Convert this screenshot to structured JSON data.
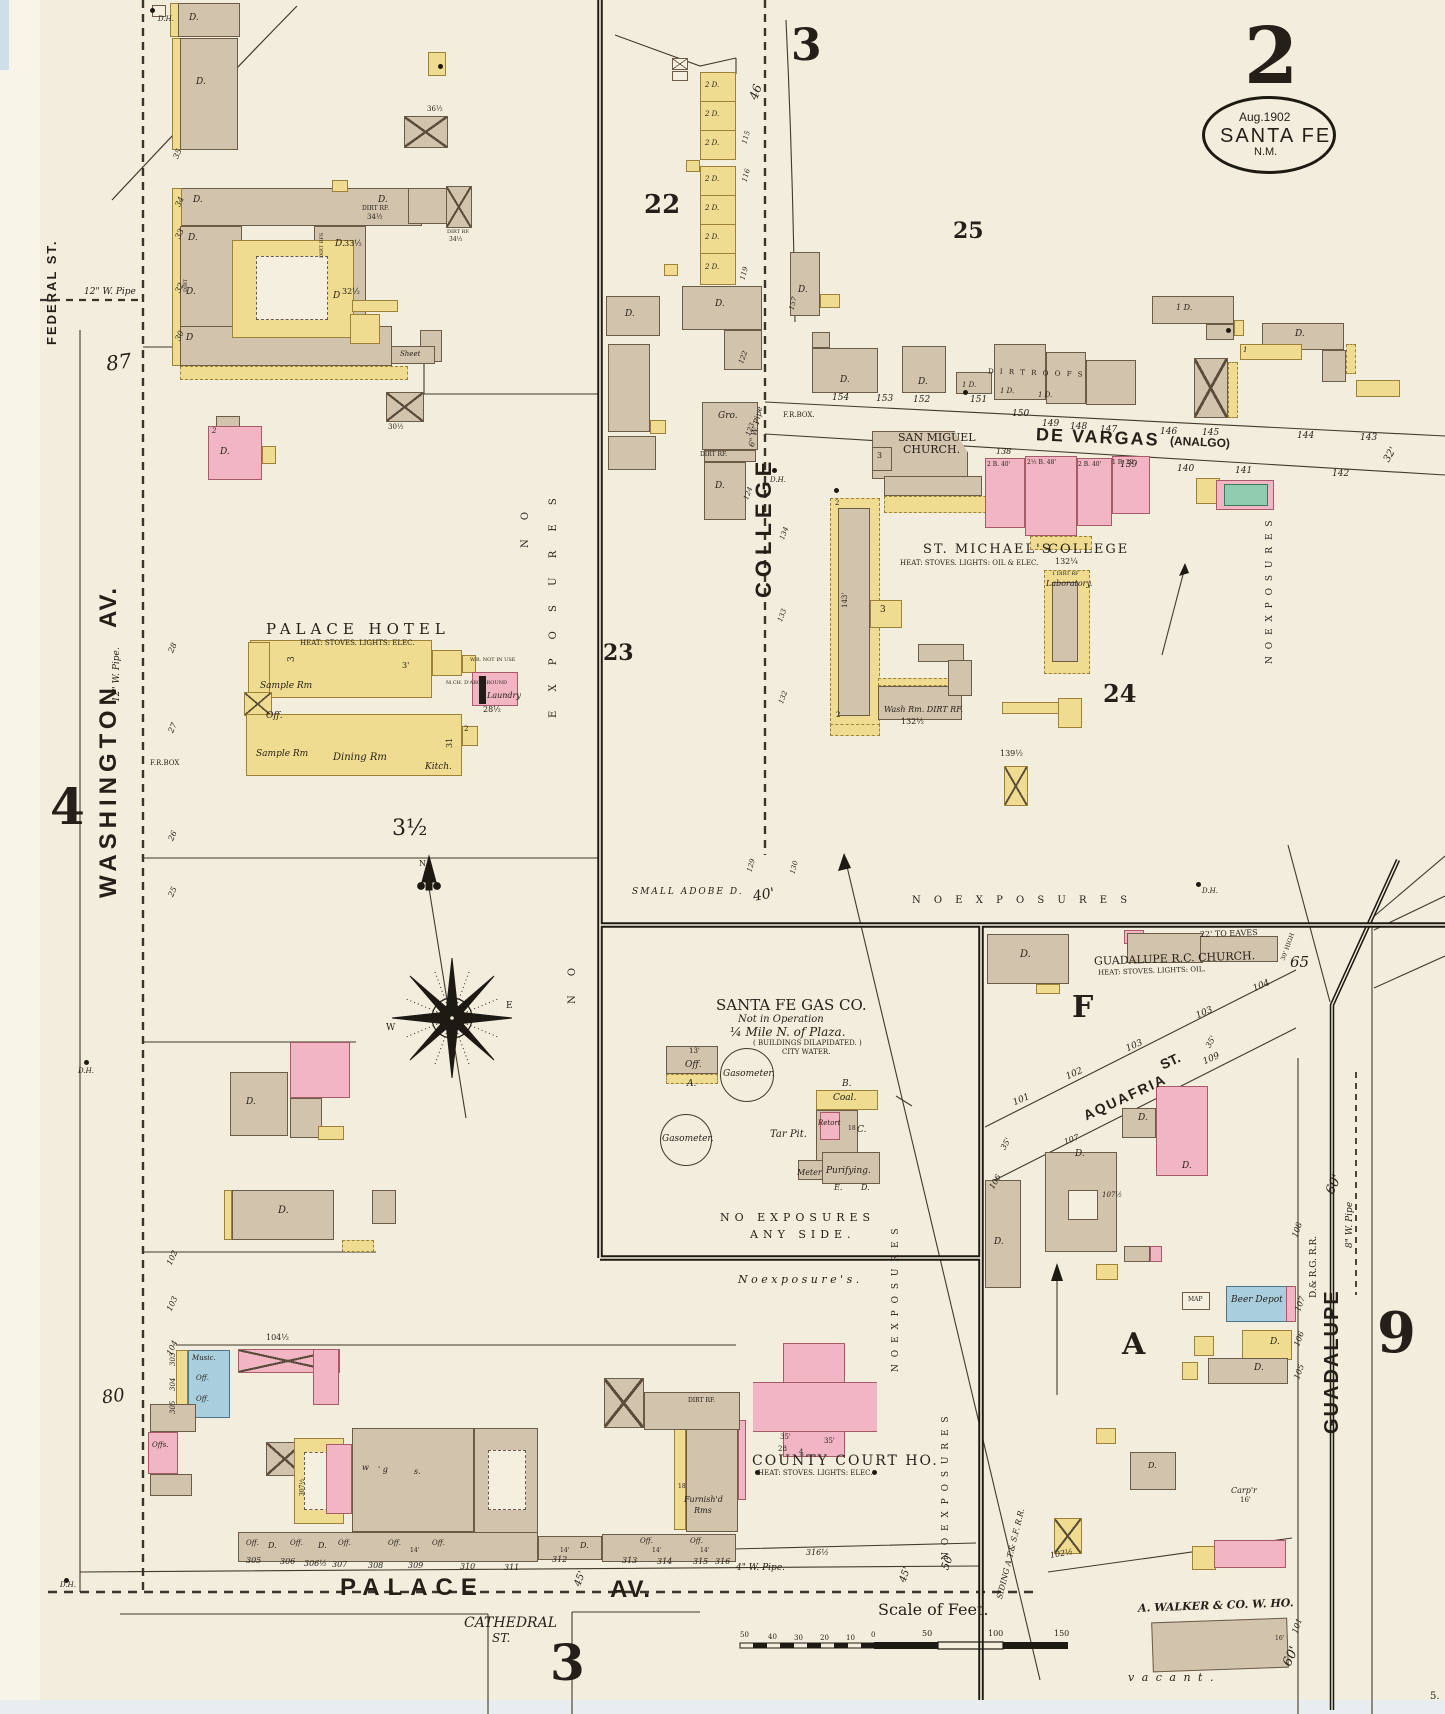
{
  "stamp": {
    "date": "Aug.1902",
    "city": "SANTA FE",
    "state": "N.M."
  },
  "sheet": {
    "number": "2",
    "corner3": "3",
    "corner4": "4",
    "corner9": "9",
    "corner3b": "3",
    "tiny5": "5."
  },
  "streets": {
    "federal": "FEDERAL ST.",
    "washington": "WASHINGTON",
    "washington_av": "AV.",
    "college": "COLLEGE",
    "de_vargas": "DE VARGAS",
    "analgo": "(ANALGO)",
    "palace": "PALACE",
    "palace_av": "AV.",
    "cathedral": "CATHEDRAL",
    "cathedral_st": "ST.",
    "aquafria": "AQUAFRIA",
    "aquafria_st": "ST.",
    "guadalupe": "GUADALUPE",
    "railroad": "D.& R.G. R.R.",
    "siding": "SIDING A.T.& S.F. R.R."
  },
  "pipes": {
    "w12a": "12\" W. Pipe",
    "w12b": "12\" W. Pipe.",
    "w6": "6\" W. Pipe",
    "w4": "4\" W. Pipe.",
    "w8": "8\" W. Pipe"
  },
  "blocks": {
    "b22": "22",
    "b23": "23",
    "b24": "24",
    "b25": "25",
    "bF": "F",
    "bA": "A",
    "b3half": "3½",
    "b87": "87",
    "b80": "80",
    "b65": "65",
    "b60a": "60'",
    "b60b": "60'",
    "b40": "40'",
    "b46": "46",
    "b50": "50'",
    "b45a": "45'",
    "b45b": "45'"
  },
  "hotel": {
    "name": "PALACE   HOTEL",
    "info": "HEAT: STOVES. LIGHTS: ELEC.",
    "sample1": "Sample Rm",
    "office": "Off.",
    "sample2": "Sample Rm",
    "dining": "Dining  Rm",
    "kitchen": "Kitch.",
    "laundry": "Laundry",
    "laundry_h": "28½",
    "h31": "31",
    "h3": "3",
    "h3f": "3'",
    "h2": "2",
    "wr": "W.R. NOT IN USE",
    "mch": "M.CH. D'ABO GROUND"
  },
  "church": {
    "name1": "SAN  MIGUEL",
    "name2": "CHURCH.",
    "t3": "3"
  },
  "college_bldg": {
    "name1": "ST.   MICHAEL'S",
    "name2": "COLLEGE",
    "info": "HEAT: STOVES. LIGHTS: OIL & ELEC.",
    "front": "132¼",
    "lab": "Laboratory.",
    "lab_rf": "1 DIRT RF",
    "wash": "Wash Rm.  DIRT RF.",
    "wash_front": "132½",
    "h143": "143'",
    "w3": "3",
    "d139": "139½",
    "c2": "2"
  },
  "gas": {
    "name": "SANTA FE GAS CO.",
    "status": "Not in Operation",
    "loc": "¼ Mile N. of Plaza.",
    "cond": "( BUILDINGS DILAPIDATED. )",
    "water": "CITY WATER.",
    "gaso": "Gasometer.",
    "off": "Off.",
    "f13": "13'",
    "la": "A.",
    "lb": "B.",
    "coal": "Coal.",
    "retort": "Retort",
    "lc": "C.",
    "l18": "18",
    "tar": "Tar Pit.",
    "meter": "Meter",
    "purif": "Purifying.",
    "le": "E.",
    "ld": "D."
  },
  "gchurch": {
    "name": "GUADALUPE R.C. CHURCH.",
    "info": "HEAT: STOVES. LIGHTS: OIL.",
    "eaves": "22' TO EAVES",
    "high": "30' HIGH"
  },
  "courthouse": {
    "name": "COUNTY  COURT  HO.",
    "info": "HEAT: STOVES. LIGHTS: ELEC.",
    "a35l": "35'",
    "a28": "28",
    "a4": "4",
    "a35r": "35'"
  },
  "walker": {
    "name": "A. WALKER & CO. W. HO.",
    "vacant": "v a c a n t .",
    "l101": "101",
    "f16": "16'"
  },
  "notes": {
    "no_v1": "N O",
    "no_v2": "E X P O S U R E S",
    "no_v3": "N O",
    "no_v4": "N O   E X P O S U R E S",
    "no_h": "N O    E X P O S U R E S",
    "no_i1": "NO   EXPOSURES",
    "no_i2": "ANY   SIDE.",
    "no_b": "N o     e x p o s u r e ' s .",
    "small_adobe": "SMALL  ADOBE  D.",
    "dh": "D.H.",
    "frbox1": "F.R.BOX",
    "frbox2": "F.R.BOX.",
    "map_tag": "MAP"
  },
  "scalebar": {
    "title": "Scale of  Feet.",
    "n50l": "50",
    "n40": "40",
    "n30": "30",
    "n20": "20",
    "n10": "10",
    "n0": "0",
    "n50": "50",
    "n100": "100",
    "n150": "150"
  },
  "compass": {
    "n": "N",
    "w": "W",
    "e": "E"
  },
  "misc": {
    "music": "Music.",
    "off": "Off.",
    "offs": "Offs.",
    "f14": "14'",
    "m104": "104½",
    "furn1": "Furnish'd",
    "furn2": "Rms",
    "f18": "18",
    "gro": "Gro.",
    "beer": "Beer  Depot",
    "carp": "Carp'r",
    "c16": "16'",
    "sheet": "Sheet",
    "dirt_roofs": "D I R T    R O O F S",
    "dirt_rf": "DIRT RF.",
    "h34a": "34½",
    "h34b": "34½",
    "h33": "33½",
    "h32": "32½",
    "h30": "30½",
    "h36": "36½",
    "dirt_rfs": "DIRT RFS",
    "dirt": "DIRT",
    "w": "w",
    "g": "' g",
    "s": "s.",
    "e307": "307½",
    "row1": "2 B. 40'",
    "row2": "2½ B. 48'",
    "row3": "2 B. 40'",
    "row4": "1 B. 22'"
  },
  "d": {
    "d": "D.",
    "dp": "D",
    "d1": "1 D.",
    "d2": "2 D.",
    "one": "1",
    "two": "2"
  },
  "lots": {
    "w35": "35",
    "w34": "34",
    "w33": "33",
    "w32": "32",
    "w30": "30",
    "w28": "28",
    "w27": "27",
    "w26": "26",
    "w25": "25",
    "w102": "102",
    "w103": "103",
    "w104": "104",
    "c122": "122",
    "c123": "123",
    "c124": "124",
    "e134": "134",
    "e133": "133",
    "e132": "132",
    "r115": "115",
    "r116": "116",
    "r119": "119",
    "r129": "129",
    "r130": "130",
    "m157": "157",
    "dv138": "138",
    "dv139": "139",
    "dv140": "140",
    "dv141": "141",
    "dv142": "142",
    "dv143": "143",
    "dv144": "144",
    "dv145": "145",
    "dv146": "146",
    "dv147": "147",
    "dv148": "148",
    "dv149": "149",
    "dv150": "150",
    "dv151": "151",
    "dv152": "152",
    "dv153": "153",
    "dv154": "154",
    "dv32": "32'",
    "a101": "101",
    "a102": "102",
    "a103a": "103",
    "a103b": "103",
    "a104": "104",
    "a109": "109",
    "a35a": "35'",
    "a35b": "35'",
    "a106": "106",
    "a107": "107",
    "a107h": "107½",
    "g105": "105",
    "g106": "106",
    "g107": "107",
    "g108": "108",
    "ba102h": "102½",
    "l305": "305",
    "l306": "306",
    "l306h": "306½",
    "l307": "307",
    "l308": "308",
    "l309": "309",
    "l310": "310",
    "l311": "311",
    "l312": "312",
    "l313": "313",
    "l314": "314",
    "l315": "315",
    "l316": "316",
    "l316h": "316½",
    "lc303": "303",
    "lc304": "304",
    "lc305": "305"
  }
}
